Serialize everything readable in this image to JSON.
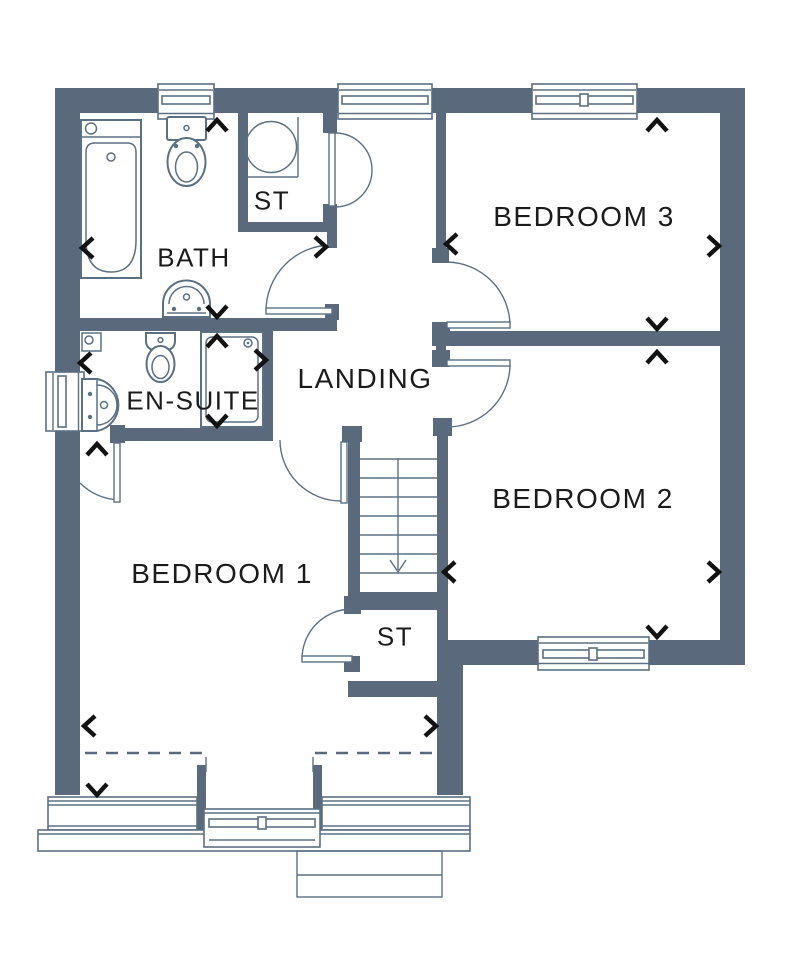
{
  "rooms": {
    "bath": {
      "label": "BATH"
    },
    "st_top": {
      "label": "ST"
    },
    "bedroom3": {
      "label": "BEDROOM 3"
    },
    "ensuite": {
      "label": "EN-SUITE"
    },
    "landing": {
      "label": "LANDING"
    },
    "bedroom2": {
      "label": "BEDROOM 2"
    },
    "bedroom1": {
      "label": "BEDROOM 1"
    },
    "st_bottom": {
      "label": "ST"
    }
  },
  "stairs": {
    "direction": "down"
  },
  "fixtures": {
    "bath": [
      "bathtub-icon",
      "toilet-icon",
      "basin-icon"
    ],
    "ensuite": [
      "toilet-icon",
      "basin-icon",
      "shower-icon",
      "corner-unit-icon"
    ],
    "st_top": [
      "water-tank-icon"
    ]
  },
  "colors": {
    "wall": "#5a6a7c",
    "line": "#5b7083",
    "text": "#1b1b1b",
    "arrow": "#121212",
    "background": "#ffffff"
  }
}
